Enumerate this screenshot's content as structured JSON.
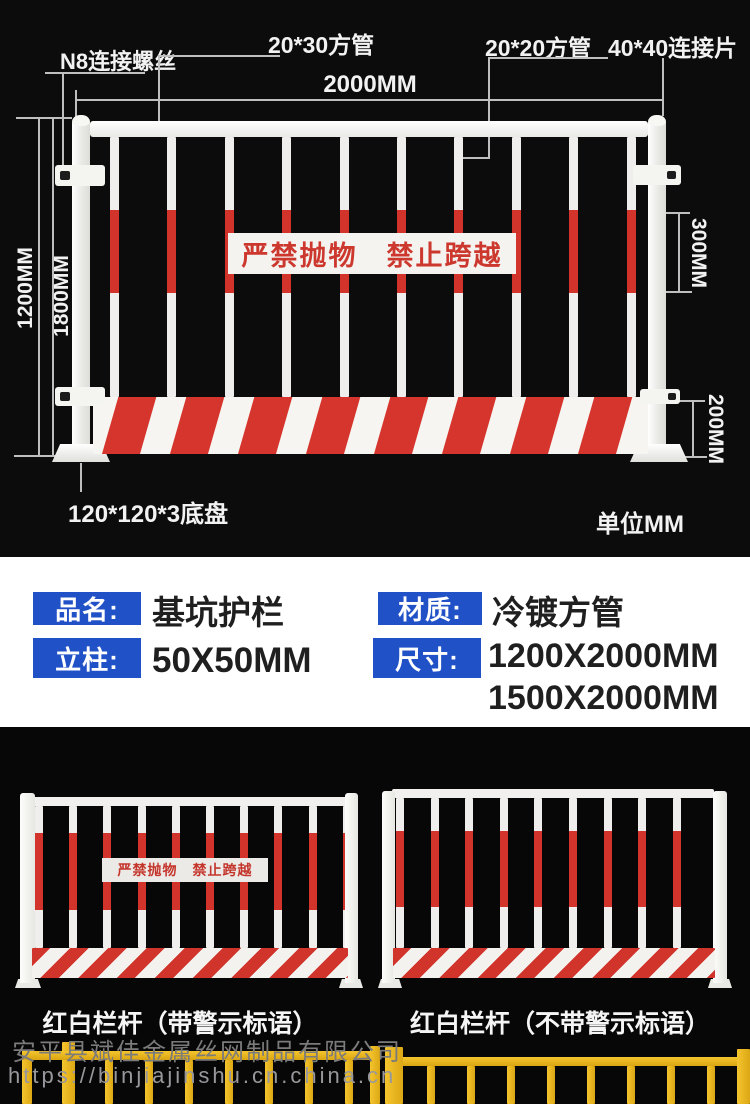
{
  "colors": {
    "accent_blue": "#2151c7",
    "red": "#d5352c",
    "yellow": "#eab61e",
    "background": "#0c0c0c"
  },
  "diagram": {
    "parts": {
      "screw": "N8连接螺丝",
      "top_tube": "20*30方管",
      "picket_tube": "20*20方管",
      "connector": "40*40连接片",
      "base_plate": "120*120*3底盘"
    },
    "dims": {
      "width": "2000MM",
      "panel_height": "1200MM",
      "total_height": "1800MM",
      "reflective": "300MM",
      "board": "200MM"
    },
    "unit_note": "单位MM",
    "sign": "严禁抛物　禁止跨越"
  },
  "specs": {
    "items": [
      {
        "label": "品名:",
        "value": "基坑护栏"
      },
      {
        "label": "材质:",
        "value": "冷镀方管"
      },
      {
        "label": "立柱:",
        "value": "50X50MM"
      },
      {
        "label": "尺寸:",
        "value": "1200X2000MM",
        "value2": "1500X2000MM"
      }
    ]
  },
  "photos": {
    "sign": "严禁抛物　禁止跨越",
    "left_caption": "红白栏杆（带警示标语）",
    "right_caption": "红白栏杆（不带警示标语）"
  },
  "watermark": {
    "company": "安平县斌佳金属丝网制品有限公司",
    "url": "https://binjiajinshu.cn.china.cn"
  }
}
